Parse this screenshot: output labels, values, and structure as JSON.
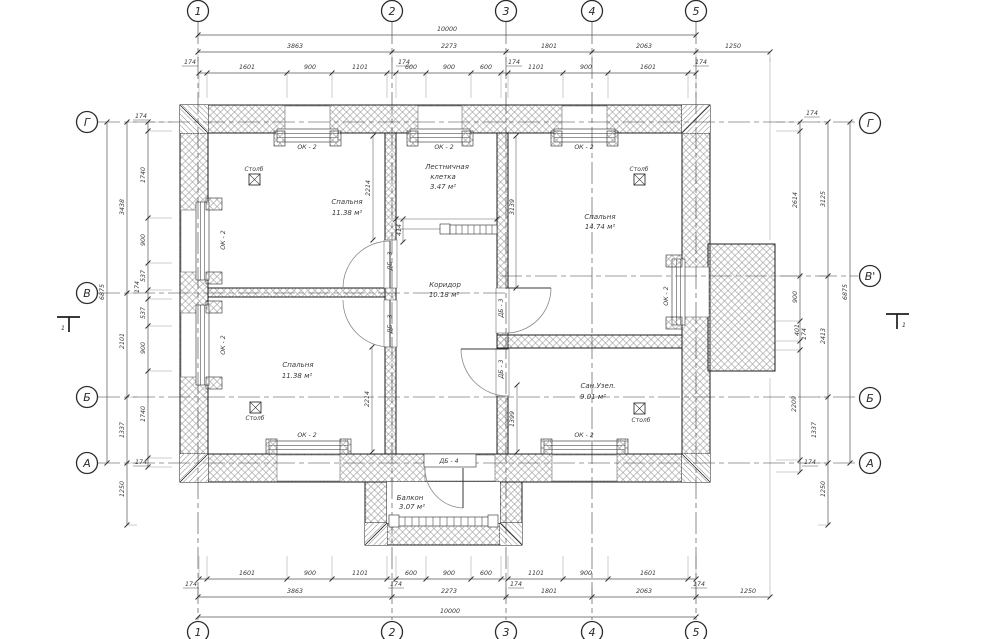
{
  "meta": {
    "drawing_type": "floor plan",
    "language": "ru"
  },
  "axes": {
    "markers": [
      {
        "t": "1",
        "x": 198,
        "y": 11
      },
      {
        "t": "2",
        "x": 392,
        "y": 11
      },
      {
        "t": "3",
        "x": 506,
        "y": 11
      },
      {
        "t": "4",
        "x": 592,
        "y": 11
      },
      {
        "t": "5",
        "x": 696,
        "y": 11
      },
      {
        "t": "1",
        "x": 198,
        "y": 632
      },
      {
        "t": "2",
        "x": 392,
        "y": 632
      },
      {
        "t": "3",
        "x": 506,
        "y": 632
      },
      {
        "t": "4",
        "x": 592,
        "y": 632
      },
      {
        "t": "5",
        "x": 696,
        "y": 632
      },
      {
        "t": "Г",
        "x": 87,
        "y": 122
      },
      {
        "t": "В",
        "x": 87,
        "y": 293
      },
      {
        "t": "Б",
        "x": 87,
        "y": 397
      },
      {
        "t": "А",
        "x": 87,
        "y": 463
      },
      {
        "t": "Г",
        "x": 870,
        "y": 123
      },
      {
        "t": "В'",
        "x": 870,
        "y": 276
      },
      {
        "t": "Б",
        "x": 870,
        "y": 398
      },
      {
        "t": "А",
        "x": 870,
        "y": 463
      }
    ]
  },
  "text_groups": {
    "room_labels": [
      {
        "t": "Спальня",
        "x": 347,
        "y": 204
      },
      {
        "t": "11.38 м²",
        "x": 347,
        "y": 215
      },
      {
        "t": "Лестничная",
        "x": 447,
        "y": 169
      },
      {
        "t": "клетка",
        "x": 443,
        "y": 179
      },
      {
        "t": "3.47 м²",
        "x": 443,
        "y": 189
      },
      {
        "t": "Коридор",
        "x": 445,
        "y": 287
      },
      {
        "t": "10.18 м²",
        "x": 444,
        "y": 297
      },
      {
        "t": "Спальня",
        "x": 600,
        "y": 219
      },
      {
        "t": "14.74 м²",
        "x": 600,
        "y": 229
      },
      {
        "t": "Спальня",
        "x": 298,
        "y": 367
      },
      {
        "t": "11.38 м²",
        "x": 297,
        "y": 378
      },
      {
        "t": "Сан.Узел.",
        "x": 598,
        "y": 388
      },
      {
        "t": "9.01 м²",
        "x": 593,
        "y": 399
      },
      {
        "t": "Балкон",
        "x": 410,
        "y": 500
      },
      {
        "t": "3.07 м²",
        "x": 412,
        "y": 509
      }
    ],
    "column_labels": [
      {
        "t": "Столб",
        "x": 254,
        "y": 171
      },
      {
        "t": "Столб",
        "x": 639,
        "y": 171
      },
      {
        "t": "Столб",
        "x": 255,
        "y": 420
      },
      {
        "t": "Столб",
        "x": 641,
        "y": 422
      }
    ],
    "window_labels": [
      {
        "t": "ОК - 2",
        "x": 307,
        "y": 149
      },
      {
        "t": "ОК - 2",
        "x": 444,
        "y": 149
      },
      {
        "t": "ОК - 2",
        "x": 584,
        "y": 149
      },
      {
        "t": "ОК - 2",
        "x": 225,
        "y": 240,
        "r": -90
      },
      {
        "t": "ОК - 2",
        "x": 225,
        "y": 345,
        "r": -90
      },
      {
        "t": "ОК - 2",
        "x": 307,
        "y": 437
      },
      {
        "t": "ОК - 2",
        "x": 584,
        "y": 437
      },
      {
        "t": "ОК - 2",
        "x": 668,
        "y": 296,
        "r": -90
      }
    ],
    "door_labels": [
      {
        "t": "ДБ - 3",
        "x": 392,
        "y": 261,
        "r": -90
      },
      {
        "t": "ДБ - 3",
        "x": 392,
        "y": 324,
        "r": -90
      },
      {
        "t": "ДБ - 3",
        "x": 503,
        "y": 308,
        "r": -90
      },
      {
        "t": "ДБ - 3",
        "x": 503,
        "y": 369,
        "r": -90
      },
      {
        "t": "ДБ - 4",
        "x": 449,
        "y": 463
      }
    ],
    "dim_top": [
      {
        "t": "10000",
        "x": 447,
        "y": 31
      },
      {
        "t": "3863",
        "x": 295,
        "y": 48
      },
      {
        "t": "2273",
        "x": 449,
        "y": 48
      },
      {
        "t": "1801",
        "x": 549,
        "y": 48
      },
      {
        "t": "2063",
        "x": 644,
        "y": 48
      },
      {
        "t": "1250",
        "x": 733,
        "y": 48
      },
      {
        "t": "174",
        "x": 190,
        "y": 64,
        "u": 1
      },
      {
        "t": "1601",
        "x": 247,
        "y": 69
      },
      {
        "t": "900",
        "x": 310,
        "y": 69
      },
      {
        "t": "1101",
        "x": 360,
        "y": 69
      },
      {
        "t": "174",
        "x": 404,
        "y": 64,
        "u": 1
      },
      {
        "t": "600",
        "x": 411,
        "y": 69
      },
      {
        "t": "900",
        "x": 449,
        "y": 69
      },
      {
        "t": "600",
        "x": 486,
        "y": 69
      },
      {
        "t": "174",
        "x": 514,
        "y": 64,
        "u": 1
      },
      {
        "t": "1101",
        "x": 536,
        "y": 69
      },
      {
        "t": "900",
        "x": 586,
        "y": 69
      },
      {
        "t": "1601",
        "x": 648,
        "y": 69
      },
      {
        "t": "174",
        "x": 701,
        "y": 64,
        "u": 1
      }
    ],
    "dim_bottom": [
      {
        "t": "1601",
        "x": 247,
        "y": 575
      },
      {
        "t": "900",
        "x": 310,
        "y": 575
      },
      {
        "t": "1101",
        "x": 360,
        "y": 575
      },
      {
        "t": "600",
        "x": 411,
        "y": 575
      },
      {
        "t": "900",
        "x": 449,
        "y": 575
      },
      {
        "t": "600",
        "x": 486,
        "y": 575
      },
      {
        "t": "1101",
        "x": 536,
        "y": 575
      },
      {
        "t": "900",
        "x": 586,
        "y": 575
      },
      {
        "t": "1601",
        "x": 648,
        "y": 575
      },
      {
        "t": "174",
        "x": 191,
        "y": 586,
        "u": 1
      },
      {
        "t": "174",
        "x": 396,
        "y": 586,
        "u": 1
      },
      {
        "t": "174",
        "x": 516,
        "y": 586,
        "u": 1
      },
      {
        "t": "174",
        "x": 699,
        "y": 586,
        "u": 1
      },
      {
        "t": "3863",
        "x": 295,
        "y": 593
      },
      {
        "t": "2273",
        "x": 449,
        "y": 593
      },
      {
        "t": "1801",
        "x": 549,
        "y": 593
      },
      {
        "t": "2063",
        "x": 644,
        "y": 593
      },
      {
        "t": "1250",
        "x": 748,
        "y": 593
      },
      {
        "t": "10000",
        "x": 450,
        "y": 613
      }
    ],
    "dim_left": [
      {
        "t": "6875",
        "x": 104,
        "y": 292,
        "r": -90
      },
      {
        "t": "3438",
        "x": 124,
        "y": 207,
        "r": -90
      },
      {
        "t": "2101",
        "x": 124,
        "y": 341,
        "r": -90
      },
      {
        "t": "1337",
        "x": 124,
        "y": 430,
        "r": -90
      },
      {
        "t": "1250",
        "x": 124,
        "y": 489,
        "r": -90
      },
      {
        "t": "174",
        "x": 141,
        "y": 118,
        "u": 1
      },
      {
        "t": "1740",
        "x": 145,
        "y": 175,
        "r": -90
      },
      {
        "t": "900",
        "x": 145,
        "y": 240,
        "r": -90
      },
      {
        "t": "537",
        "x": 145,
        "y": 276,
        "r": -90
      },
      {
        "t": "174",
        "x": 139,
        "y": 287,
        "r": -90
      },
      {
        "t": "537",
        "x": 145,
        "y": 313,
        "r": -90
      },
      {
        "t": "900",
        "x": 145,
        "y": 348,
        "r": -90
      },
      {
        "t": "1740",
        "x": 145,
        "y": 414,
        "r": -90
      },
      {
        "t": "174",
        "x": 141,
        "y": 464,
        "u": 1
      }
    ],
    "dim_right": [
      {
        "t": "6875",
        "x": 847,
        "y": 292,
        "r": -90
      },
      {
        "t": "3125",
        "x": 825,
        "y": 199,
        "r": -90
      },
      {
        "t": "2413",
        "x": 825,
        "y": 336,
        "r": -90
      },
      {
        "t": "1337",
        "x": 816,
        "y": 430,
        "r": -90
      },
      {
        "t": "1250",
        "x": 825,
        "y": 489,
        "r": -90
      },
      {
        "t": "174",
        "x": 812,
        "y": 115,
        "u": 1
      },
      {
        "t": "2614",
        "x": 797,
        "y": 200,
        "r": -90
      },
      {
        "t": "900",
        "x": 797,
        "y": 297,
        "r": -90
      },
      {
        "t": "401",
        "x": 799,
        "y": 330,
        "r": -90
      },
      {
        "t": "174",
        "x": 806,
        "y": 334,
        "r": -90
      },
      {
        "t": "2209",
        "x": 796,
        "y": 404,
        "r": -90
      },
      {
        "t": "174",
        "x": 810,
        "y": 464,
        "u": 1
      }
    ],
    "dim_interior": [
      {
        "t": "2214",
        "x": 370,
        "y": 188,
        "r": -90
      },
      {
        "t": "414",
        "x": 401,
        "y": 230,
        "r": -90
      },
      {
        "t": "3139",
        "x": 514,
        "y": 207,
        "r": -90
      },
      {
        "t": "2214",
        "x": 369,
        "y": 399,
        "r": -90
      },
      {
        "t": "1399",
        "x": 514,
        "y": 419,
        "r": -90
      }
    ],
    "section_labels": [
      {
        "t": "1",
        "x": 63,
        "y": 330
      },
      {
        "t": "1",
        "x": 904,
        "y": 327
      }
    ]
  }
}
